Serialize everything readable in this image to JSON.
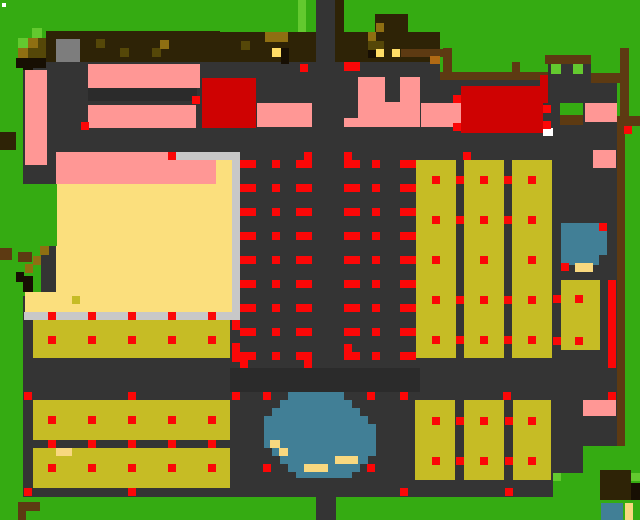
{
  "map": {
    "width": 640,
    "height": 520,
    "palette": {
      "G": "#35ab12",
      "g": "#63c92f",
      "E": "#343434",
      "e": "#2b2b2b",
      "P": "#ff9795",
      "R": "#fb0707",
      "r": "#cf0202",
      "C": "#fbdf7d",
      "O": "#c6bc25",
      "B": "#417f96",
      "S": "#c8c8c8",
      "A": "#7d7d7d",
      "N": "#2e2306",
      "M": "#5d3a12",
      "K": "#170f03",
      "U": "#8f6f12",
      "u": "#554708",
      "Y": "#ffdd66",
      "s": "#f8d87f",
      "W": "#ffffff",
      "o": "#b06a14"
    },
    "rects": [
      [
        "town-floor-west",
        23,
        62,
        417,
        435,
        "E"
      ],
      [
        "town-floor-east",
        440,
        80,
        177,
        417,
        "E"
      ],
      [
        "road-north",
        316,
        0,
        20,
        62,
        "E"
      ],
      [
        "gate-interior",
        548,
        60,
        43,
        20,
        "E"
      ],
      [
        "floor-shade-west",
        88,
        88,
        109,
        13,
        "e"
      ],
      [
        "floor-shade-center",
        230,
        368,
        190,
        24,
        "e"
      ],
      [
        "grass-bottom-band",
        0,
        497,
        640,
        23,
        "G"
      ],
      [
        "road-south",
        316,
        497,
        20,
        23,
        "E"
      ],
      [
        "grass-se-1",
        583,
        446,
        57,
        51,
        "G"
      ],
      [
        "grass-se-2",
        553,
        473,
        30,
        24,
        "G"
      ],
      [
        "grass-light-north",
        298,
        0,
        8,
        32,
        "g"
      ],
      [
        "tree-row-west",
        46,
        31,
        174,
        31,
        "N"
      ],
      [
        "bush-light-1",
        32,
        28,
        10,
        10,
        "g"
      ],
      [
        "bush-light-2",
        18,
        38,
        10,
        10,
        "g"
      ],
      [
        "bush-gold-1",
        28,
        38,
        10,
        10,
        "U"
      ],
      [
        "bush-dark-1",
        38,
        38,
        8,
        10,
        "u"
      ],
      [
        "bush-gold-2",
        18,
        48,
        10,
        10,
        "U"
      ],
      [
        "bush-dark-2",
        28,
        48,
        18,
        10,
        "u"
      ],
      [
        "bush-shadow",
        16,
        58,
        30,
        10,
        "K"
      ],
      [
        "stone-block",
        56,
        39,
        24,
        23,
        "A"
      ],
      [
        "tree-glint-1",
        96,
        39,
        9,
        9,
        "u"
      ],
      [
        "tree-glint-2",
        120,
        48,
        9,
        9,
        "u"
      ],
      [
        "tree-glint-3",
        152,
        48,
        9,
        9,
        "u"
      ],
      [
        "tree-glint-4",
        160,
        40,
        9,
        9,
        "U"
      ],
      [
        "tree-row-mid",
        220,
        32,
        96,
        30,
        "N"
      ],
      [
        "tree-gold-bar",
        265,
        32,
        23,
        10,
        "U"
      ],
      [
        "tree-glint-5",
        241,
        41,
        9,
        9,
        "u"
      ],
      [
        "tree-eye-1",
        272,
        48,
        9,
        9,
        "Y"
      ],
      [
        "tree-pupil-1",
        281,
        48,
        8,
        16,
        "K"
      ],
      [
        "tree-trunk-north",
        335,
        0,
        9,
        62,
        "N"
      ],
      [
        "tree-row-east",
        344,
        32,
        96,
        30,
        "N"
      ],
      [
        "tree-canopy-ne",
        375,
        14,
        33,
        18,
        "N"
      ],
      [
        "canopy-gold",
        376,
        23,
        8,
        9,
        "U"
      ],
      [
        "tree-glint-6",
        368,
        32,
        8,
        9,
        "U"
      ],
      [
        "tree-olive-bar",
        368,
        41,
        16,
        9,
        "u"
      ],
      [
        "tree-shadow-e",
        368,
        50,
        8,
        8,
        "K"
      ],
      [
        "tree-eye-2",
        376,
        49,
        8,
        8,
        "Y"
      ],
      [
        "tree-eye-3",
        392,
        49,
        8,
        8,
        "Y"
      ],
      [
        "branch-east",
        401,
        49,
        45,
        8,
        "M"
      ],
      [
        "stump-orange",
        430,
        56,
        10,
        8,
        "o"
      ],
      [
        "fence-post-1",
        443,
        48,
        9,
        26,
        "M"
      ],
      [
        "fence-north",
        440,
        72,
        108,
        8,
        "M"
      ],
      [
        "fence-post-2",
        512,
        62,
        8,
        18,
        "M"
      ],
      [
        "gate-roof",
        545,
        55,
        46,
        9,
        "M"
      ],
      [
        "gate-window-1",
        551,
        64,
        10,
        10,
        "g"
      ],
      [
        "gate-window-2",
        573,
        64,
        10,
        10,
        "g"
      ],
      [
        "fence-bar-ne",
        591,
        73,
        34,
        10,
        "M"
      ],
      [
        "fence-post-east",
        620,
        48,
        9,
        68,
        "M"
      ],
      [
        "fence-elbow",
        617,
        116,
        23,
        10,
        "M"
      ],
      [
        "fence-east",
        617,
        126,
        8,
        320,
        "M"
      ],
      [
        "fence-red-cell",
        624,
        126,
        8,
        8,
        "R"
      ],
      [
        "bldg-pink-west",
        25,
        70,
        22,
        95,
        "P"
      ],
      [
        "bldg-pink-a",
        88,
        64,
        112,
        24,
        "P"
      ],
      [
        "bldg-pink-b",
        88,
        105,
        108,
        23,
        "P"
      ],
      [
        "bldg-red-west",
        202,
        78,
        54,
        50,
        "r"
      ],
      [
        "bldg-pink-c",
        257,
        103,
        55,
        24,
        "P"
      ],
      [
        "bldg-pink-d",
        358,
        77,
        62,
        50,
        "P"
      ],
      [
        "bldg-pink-d-notch",
        385,
        77,
        15,
        25,
        "E"
      ],
      [
        "bldg-pink-d-foot",
        344,
        118,
        14,
        9,
        "P"
      ],
      [
        "bldg-pink-e",
        421,
        103,
        50,
        24,
        "P"
      ],
      [
        "red-edge-ne",
        540,
        75,
        8,
        28,
        "r"
      ],
      [
        "bldg-red-east",
        461,
        86,
        82,
        47,
        "r"
      ],
      [
        "bldg-door-white",
        543,
        128,
        10,
        8,
        "W"
      ],
      [
        "grass-patch-ne",
        560,
        103,
        23,
        12,
        "G"
      ],
      [
        "fence-ne-low",
        560,
        115,
        23,
        10,
        "M"
      ],
      [
        "bldg-pink-f",
        585,
        103,
        32,
        19,
        "P"
      ],
      [
        "bldg-pink-g",
        593,
        150,
        23,
        18,
        "P"
      ],
      [
        "field-cream",
        56,
        152,
        176,
        160,
        "C"
      ],
      [
        "field-pink-band",
        56,
        152,
        160,
        32,
        "P"
      ],
      [
        "silver-top",
        176,
        152,
        64,
        8,
        "S"
      ],
      [
        "silver-east",
        232,
        152,
        8,
        168,
        "S"
      ],
      [
        "silver-south",
        24,
        312,
        216,
        8,
        "S"
      ],
      [
        "grass-block-west",
        23,
        184,
        34,
        62,
        "G"
      ],
      [
        "grass-step",
        23,
        246,
        18,
        50,
        "G"
      ],
      [
        "path-gold-1",
        40,
        246,
        9,
        9,
        "U"
      ],
      [
        "path-brown-1",
        0,
        248,
        12,
        12,
        "M"
      ],
      [
        "path-brown-2",
        18,
        252,
        14,
        10,
        "M"
      ],
      [
        "path-gold-2",
        33,
        256,
        8,
        9,
        "U"
      ],
      [
        "path-gold-3",
        25,
        264,
        8,
        9,
        "U"
      ],
      [
        "path-dark-1",
        16,
        272,
        8,
        10,
        "K"
      ],
      [
        "path-dark-2",
        23,
        276,
        10,
        16,
        "K"
      ],
      [
        "field-cream-sw",
        25,
        292,
        31,
        20,
        "C"
      ],
      [
        "field-weed",
        72,
        296,
        8,
        8,
        "O"
      ],
      [
        "field-col-1",
        416,
        160,
        40,
        198,
        "O"
      ],
      [
        "field-col-2",
        464,
        160,
        40,
        198,
        "O"
      ],
      [
        "field-col-3",
        512,
        160,
        40,
        198,
        "O"
      ],
      [
        "pond-east",
        561,
        223,
        46,
        42,
        "B"
      ],
      [
        "pond-east-notch",
        599,
        255,
        8,
        10,
        "E"
      ],
      [
        "sand-east",
        575,
        263,
        18,
        9,
        "s"
      ],
      [
        "field-col-4",
        561,
        280,
        39,
        70,
        "O"
      ],
      [
        "red-stripe-east",
        608,
        280,
        8,
        88,
        "R"
      ],
      [
        "field-strip-a",
        33,
        320,
        197,
        38,
        "O"
      ],
      [
        "field-strip-b",
        33,
        400,
        197,
        40,
        "O"
      ],
      [
        "field-strip-c",
        33,
        448,
        197,
        40,
        "O"
      ],
      [
        "sand-strip-c",
        56,
        448,
        16,
        8,
        "s"
      ],
      [
        "red-col-west-1",
        232,
        320,
        8,
        10,
        "R"
      ],
      [
        "red-col-west-2",
        232,
        343,
        8,
        19,
        "R"
      ],
      [
        "pond-row-1",
        288,
        392,
        56,
        8,
        "B"
      ],
      [
        "pond-row-2",
        280,
        400,
        72,
        8,
        "B"
      ],
      [
        "pond-row-3",
        272,
        408,
        88,
        8,
        "B"
      ],
      [
        "pond-row-4",
        264,
        416,
        104,
        8,
        "B"
      ],
      [
        "pond-row-5",
        264,
        424,
        112,
        16,
        "B"
      ],
      [
        "pond-row-6",
        264,
        440,
        112,
        8,
        "B"
      ],
      [
        "pond-row-7",
        272,
        448,
        104,
        8,
        "B"
      ],
      [
        "pond-row-8",
        280,
        456,
        88,
        8,
        "B"
      ],
      [
        "pond-row-9",
        288,
        464,
        72,
        8,
        "B"
      ],
      [
        "pond-row-10",
        296,
        472,
        56,
        6,
        "B"
      ],
      [
        "pond-sand-1",
        270,
        440,
        10,
        8,
        "s"
      ],
      [
        "pond-sand-2",
        279,
        448,
        9,
        8,
        "s"
      ],
      [
        "pond-sand-3",
        335,
        456,
        23,
        8,
        "s"
      ],
      [
        "pond-sand-4",
        304,
        464,
        24,
        8,
        "s"
      ],
      [
        "field-col-1b",
        415,
        400,
        40,
        80,
        "O"
      ],
      [
        "field-col-2b",
        464,
        400,
        40,
        80,
        "O"
      ],
      [
        "field-col-3b",
        513,
        400,
        38,
        80,
        "O"
      ],
      [
        "bldg-pink-se",
        583,
        400,
        33,
        16,
        "P"
      ],
      [
        "tree-se",
        600,
        470,
        31,
        30,
        "N"
      ],
      [
        "tree-se-dark",
        631,
        483,
        9,
        17,
        "K"
      ],
      [
        "grass-light-se-1",
        631,
        473,
        9,
        8,
        "g"
      ],
      [
        "grass-light-se-2",
        553,
        473,
        8,
        8,
        "g"
      ],
      [
        "pond-se",
        601,
        503,
        22,
        17,
        "B"
      ],
      [
        "sand-se",
        625,
        503,
        8,
        17,
        "s"
      ],
      [
        "path-sw-1",
        18,
        502,
        22,
        9,
        "M"
      ],
      [
        "path-sw-2",
        18,
        511,
        8,
        9,
        "M"
      ],
      [
        "log-west",
        0,
        132,
        16,
        18,
        "N"
      ],
      [
        "shadow-nw",
        23,
        62,
        10,
        8,
        "K"
      ],
      [
        "cursor-dot",
        2,
        3,
        4,
        4,
        "W"
      ],
      [
        "marker-top-bar",
        344,
        62,
        16,
        9,
        "R"
      ]
    ],
    "red_grid": {
      "rows": [
        160,
        184,
        208,
        232,
        256,
        280,
        304,
        328,
        352
      ],
      "bar_xs": [
        240,
        296,
        344,
        400
      ],
      "bar_w": 16,
      "square_xs": [
        272,
        372
      ],
      "square_w": 8,
      "feet": [
        [
          304,
          152
        ],
        [
          344,
          152
        ],
        [
          240,
          360
        ],
        [
          304,
          360
        ],
        [
          344,
          344
        ],
        [
          232,
          352
        ]
      ]
    },
    "red_dot_grids": [
      {
        "name": "field-col-dots",
        "xs": [
          432,
          480,
          528
        ],
        "ys": [
          176,
          216,
          256,
          296,
          336
        ]
      },
      {
        "name": "field-border-dots",
        "xs": [
          456,
          504
        ],
        "ys": [
          176,
          216,
          296,
          336
        ]
      },
      {
        "name": "strip-dots",
        "xs": [
          48,
          88,
          128,
          168,
          208
        ],
        "ys": [
          312,
          336,
          416,
          440,
          464
        ]
      },
      {
        "name": "se-block-dots",
        "xs": [
          432,
          480,
          528
        ],
        "ys": [
          417,
          457
        ]
      },
      {
        "name": "se-border-dots",
        "xs": [
          456,
          505
        ],
        "ys": [
          417,
          457
        ]
      }
    ],
    "red_points": [
      [
        300,
        64
      ],
      [
        81,
        122
      ],
      [
        192,
        96
      ],
      [
        453,
        95
      ],
      [
        453,
        123
      ],
      [
        168,
        152
      ],
      [
        463,
        152
      ],
      [
        599,
        223
      ],
      [
        561,
        263
      ],
      [
        553,
        295
      ],
      [
        575,
        295
      ],
      [
        553,
        337
      ],
      [
        575,
        337
      ],
      [
        24,
        392
      ],
      [
        128,
        392
      ],
      [
        232,
        392
      ],
      [
        24,
        488
      ],
      [
        128,
        488
      ],
      [
        263,
        392
      ],
      [
        367,
        392
      ],
      [
        400,
        392
      ],
      [
        503,
        392
      ],
      [
        608,
        392
      ],
      [
        263,
        464
      ],
      [
        367,
        464
      ],
      [
        400,
        488
      ],
      [
        505,
        488
      ],
      [
        543,
        105
      ],
      [
        543,
        121
      ]
    ]
  }
}
